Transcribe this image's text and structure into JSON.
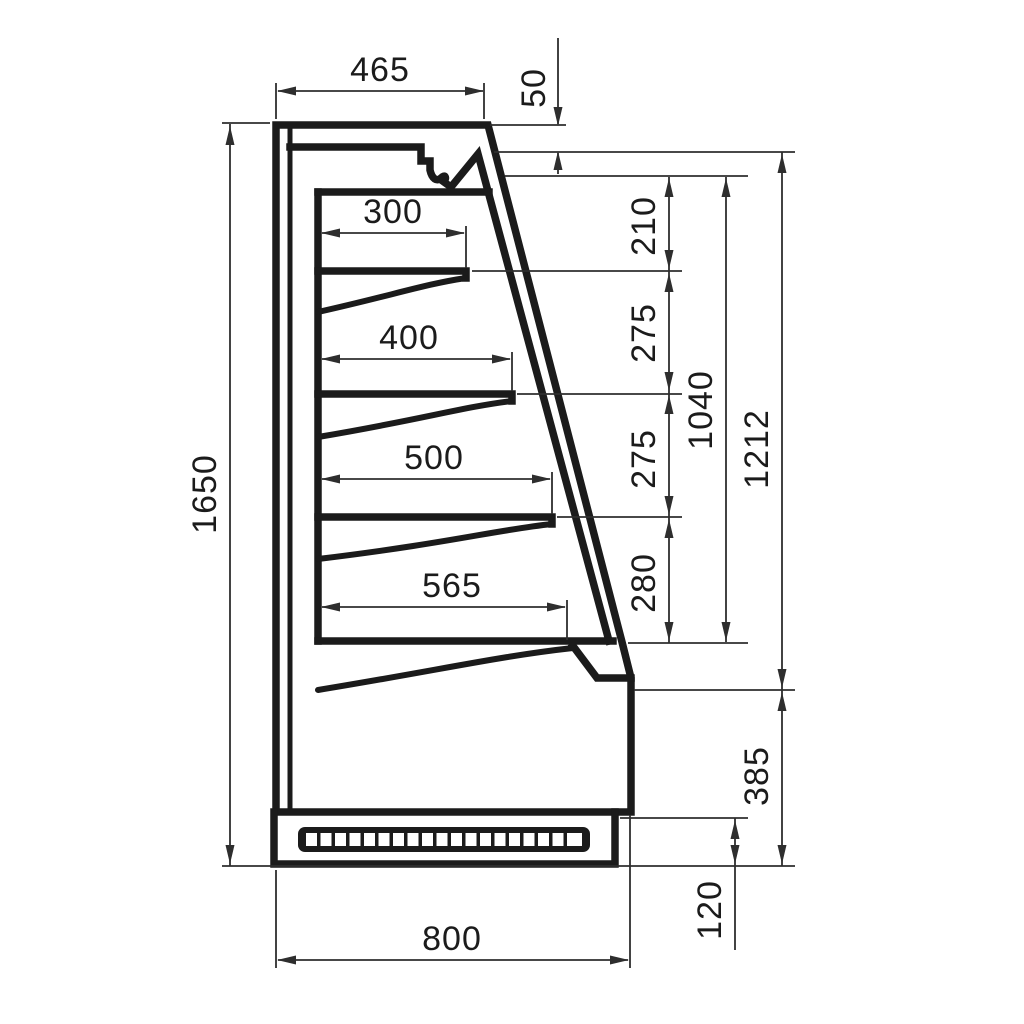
{
  "colors": {
    "line": "#1b1b1b",
    "dim": "#2e2e2e",
    "background": "#ffffff"
  },
  "dims": {
    "top_depth": "465",
    "canopy_height": "50",
    "shelf_1_depth": "300",
    "shelf_2_depth": "400",
    "shelf_3_depth": "500",
    "base_shelf_depth": "565",
    "spacing_1": "210",
    "spacing_2": "275",
    "spacing_3": "275",
    "spacing_4": "280",
    "opening_height": "1040",
    "front_height": "1212",
    "lower_front_height": "385",
    "plinth_height": "120",
    "total_height": "1650",
    "total_depth": "800"
  }
}
